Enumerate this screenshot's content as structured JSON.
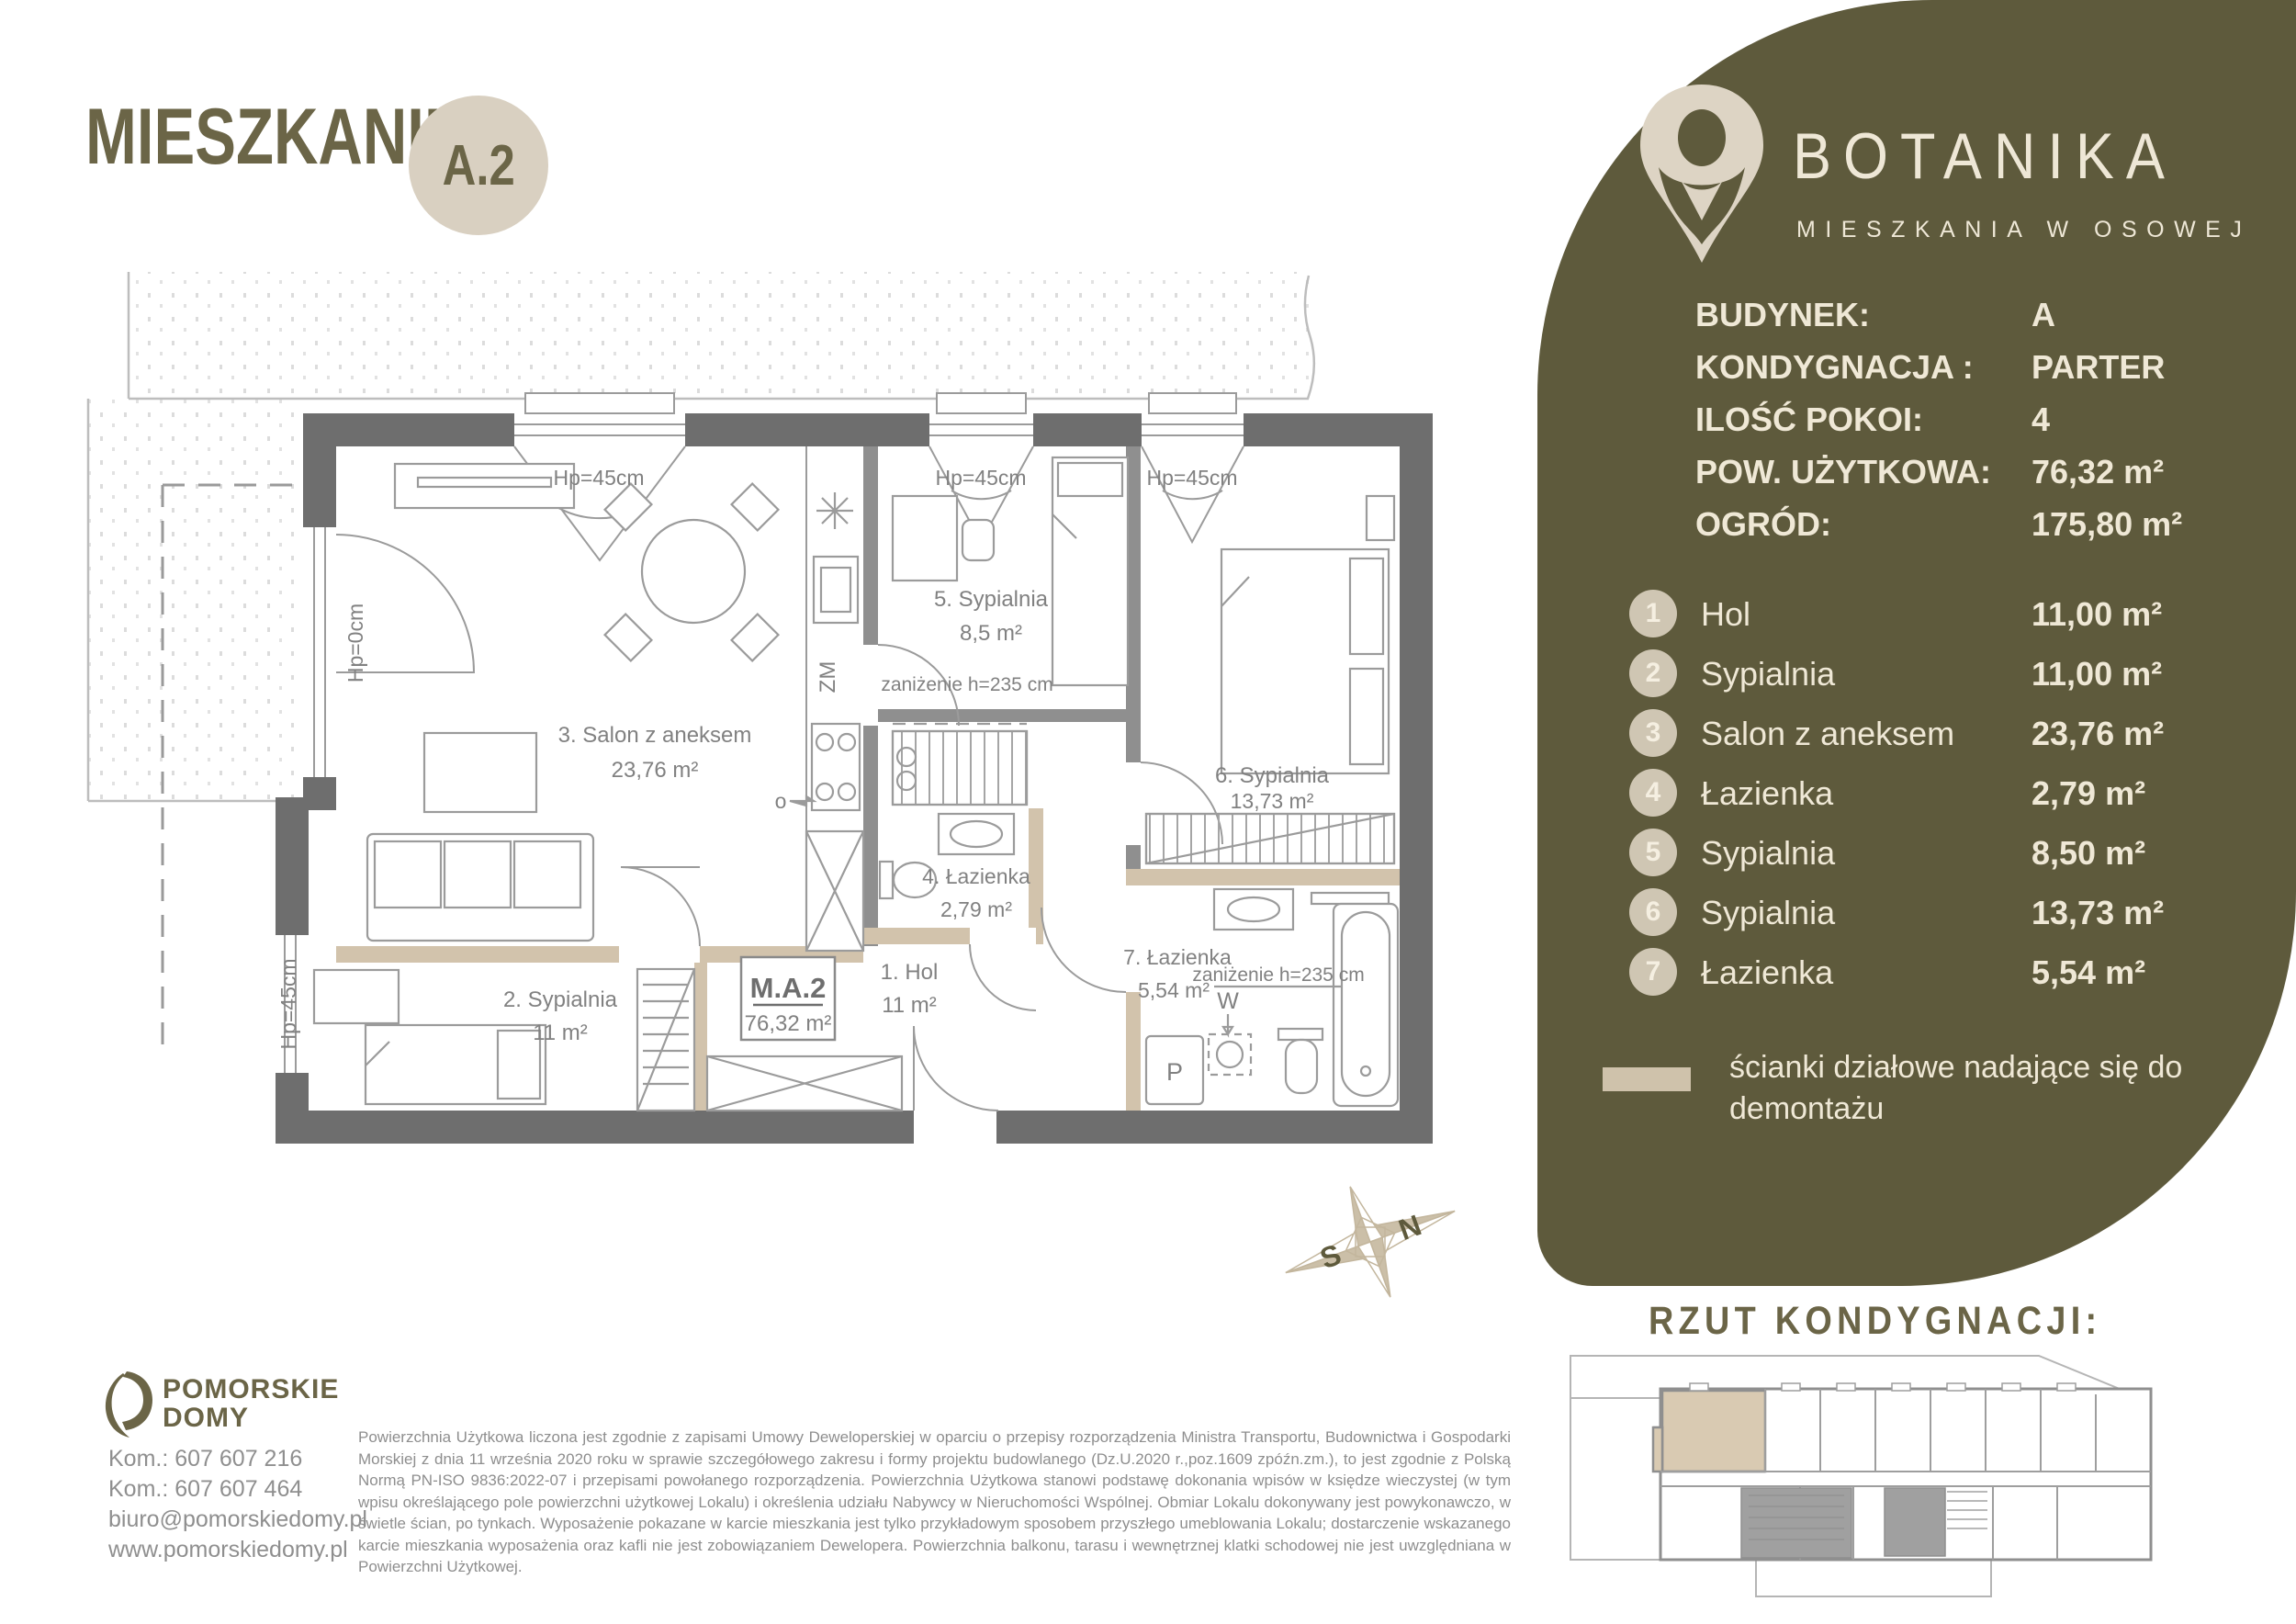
{
  "header": {
    "title": "MIESZKANIE",
    "unit_badge": "A.2"
  },
  "sidebar": {
    "brand": {
      "name": "BOTANIKA",
      "tagline": "MIESZKANIA W OSOWEJ"
    },
    "specs": [
      {
        "label": "BUDYNEK:",
        "value": "A"
      },
      {
        "label": "KONDYGNACJA :",
        "value": "PARTER"
      },
      {
        "label": "ILOŚĆ POKOI:",
        "value": "4"
      },
      {
        "label": "POW. UŻYTKOWA:",
        "value": "76,32 m²"
      },
      {
        "label": "OGRÓD:",
        "value": "175,80 m²"
      }
    ],
    "rooms": [
      {
        "no": "1",
        "name": "Hol",
        "area": "11,00 m²"
      },
      {
        "no": "2",
        "name": "Sypialnia",
        "area": "11,00 m²"
      },
      {
        "no": "3",
        "name": "Salon z aneksem",
        "area": "23,76 m²"
      },
      {
        "no": "4",
        "name": "Łazienka",
        "area": "2,79 m²"
      },
      {
        "no": "5",
        "name": "Sypialnia",
        "area": "8,50 m²"
      },
      {
        "no": "6",
        "name": "Sypialnia",
        "area": "13,73 m²"
      },
      {
        "no": "7",
        "name": "Łazienka",
        "area": "5,54 m²"
      }
    ],
    "legend": "ścianki działowe nadające się do demontażu"
  },
  "plan": {
    "unit": {
      "label": "M.A.2",
      "area": "76,32 m²"
    },
    "rooms": {
      "salon": {
        "name": "3. Salon z aneksem",
        "area": "23,76 m²"
      },
      "syp2": {
        "name": "2. Sypialnia",
        "area": "11 m²"
      },
      "syp5": {
        "name": "5. Sypialnia",
        "area": "8,5 m²"
      },
      "syp6": {
        "name": "6. Sypialnia",
        "area": "13,73 m²"
      },
      "laz4": {
        "name": "4. Łazienka",
        "area": "2,79 m²"
      },
      "laz7": {
        "name": "7. Łazienka",
        "area": "5,54 m²"
      },
      "hol": {
        "name": "1. Hol",
        "area": "11 m²"
      }
    },
    "annotations": {
      "hp45": "Hp=45cm",
      "hp0": "Hp=0cm",
      "lowering": "zaniżenie h=235 cm",
      "zm": "ZM",
      "w": "W",
      "p": "P",
      "o": "o"
    },
    "compass": {
      "n": "N",
      "s": "S"
    }
  },
  "floor_overview": {
    "title": "RZUT KONDYGNACJI:"
  },
  "footer": {
    "company": {
      "line1": "POMORSKIE",
      "line2": "DOMY"
    },
    "contacts": "Kom.: 607 607 216\nKom.: 607 607 464\nbiuro@pomorskiedomy.pl\nwww.pomorskiedomy.pl",
    "disclaimer": "Powierzchnia Użytkowa liczona jest zgodnie z zapisami Umowy Deweloperskiej w oparciu o przepisy rozporządzenia Ministra Transportu, Budownictwa i Gospodarki Morskiej z dnia 11 września 2020 roku w sprawie szczegółowego zakresu i formy projektu budowlanego (Dz.U.2020 r.,poz.1609 zpóźn.zm.), to jest zgodnie z Polską Normą PN-ISO 9836:2022-07 i przepisami powołanego rozporządzenia. Powierzchnia Użytkowa stanowi podstawę dokonania wpisów w księdze wieczystej (w tym wpisu określającego pole powierzchni użytkowej Lokalu) i określenia udziału Nabywcy w Nieruchomości Wspólnej. Obmiar Lokalu dokonywany jest powykonawczo, w świetle ścian, po tynkach. Wyposażenie pokazane w karcie mieszkania jest tylko przykładowym sposobem przyszłego umeblowania Lokalu; dostarczenie wskazanego karcie mieszkania wyposażenia oraz kafli nie jest zobowiązaniem Dewelopera. Powierzchnia balkonu, tarasu i wewnętrznej klatki schodowej nie jest uwzględniana w Powierzchni Użytkowej."
  },
  "colors": {
    "olive": "#5e5a3c",
    "olive_light": "#6b6547",
    "beige": "#d9d0c1",
    "beige_circle": "#cfc6b3",
    "cream": "#efe8d6",
    "wall_gray": "#6e6e6e",
    "partition_beige": "#d2c3ac",
    "plan_text": "#818181",
    "highlight_unit": "#d9cab2"
  }
}
